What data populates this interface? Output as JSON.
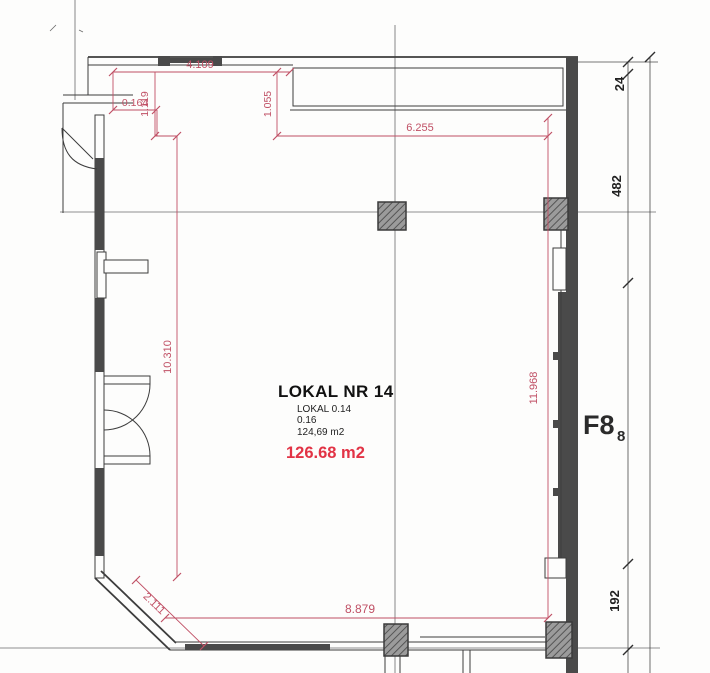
{
  "drawing": {
    "unit": {
      "title": "LOKAL NR 14",
      "alt_ref": "LOKAL 0.14",
      "alt_number": "0.16",
      "alt_area": "124,69 m2",
      "area": "126.68 m2"
    },
    "axis_label": {
      "main": "F8",
      "sub": "8"
    },
    "red_dimensions": {
      "top_opening_width": "4.109",
      "top_left_recess": "1.119",
      "top_left_offset": "0.164",
      "top_right_recess": "1.055",
      "top_width": "6.255",
      "left_height": "10.310",
      "right_height": "11.968",
      "corner_diagonal": "2.111",
      "bottom_width": "8.879"
    },
    "black_dimensions": {
      "top": "24",
      "middle": "482",
      "bottom": "192"
    },
    "colors": {
      "dimension_red": "#c05065",
      "area_red": "#e23345",
      "wall_fill": "#4a4a4a",
      "line": "#3d3d3d"
    }
  }
}
